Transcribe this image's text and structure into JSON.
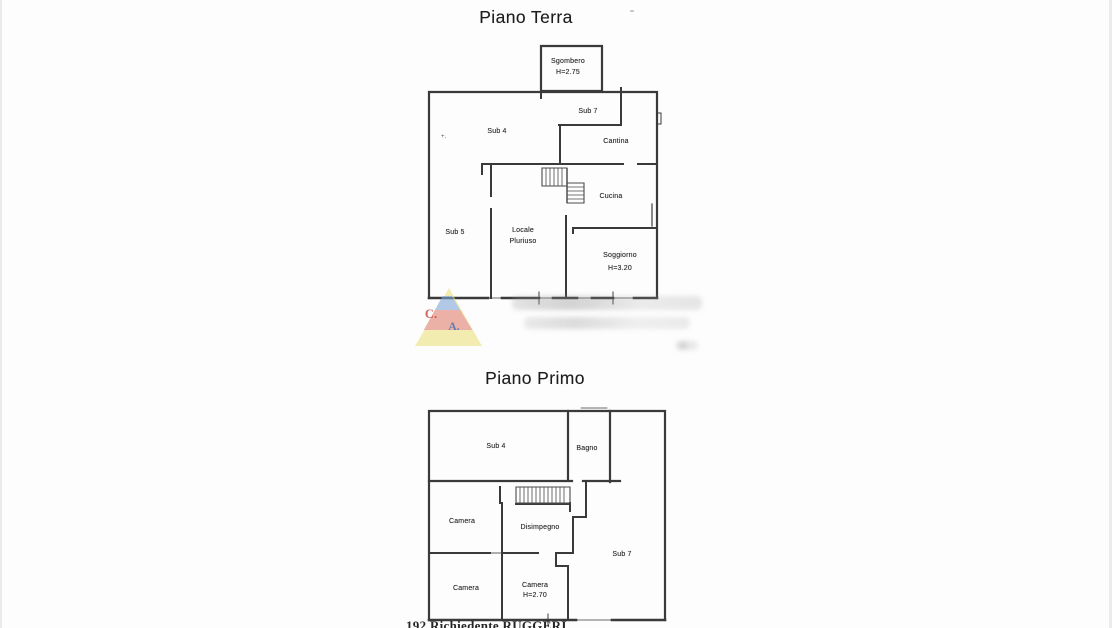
{
  "page": {
    "background": "#fdfdfd",
    "line_color": "#3a3a3a",
    "footer_text": "192   Richiedente RUGGERI",
    "artifact_text": "+."
  },
  "floors": [
    {
      "title": "Piano Terra",
      "rooms": [
        {
          "name": "Sgombero",
          "detail": "H=2.75"
        },
        {
          "name": "Sub 7",
          "detail": ""
        },
        {
          "name": "Sub 4",
          "detail": ""
        },
        {
          "name": "Cantina",
          "detail": ""
        },
        {
          "name": "Cucina",
          "detail": ""
        },
        {
          "name": "Sub 5",
          "detail": ""
        },
        {
          "name": "Locale",
          "detail": "Pluriuso"
        },
        {
          "name": "Soggiorno",
          "detail": "H=3.20"
        }
      ]
    },
    {
      "title": "Piano Primo",
      "rooms": [
        {
          "name": "Sub 4",
          "detail": ""
        },
        {
          "name": "Bagno",
          "detail": ""
        },
        {
          "name": "Camera",
          "detail": ""
        },
        {
          "name": "Disimpegno",
          "detail": ""
        },
        {
          "name": "Sub 7",
          "detail": ""
        },
        {
          "name": "Camera",
          "detail": ""
        },
        {
          "name": "Camera",
          "detail": "H=2.70"
        }
      ]
    }
  ],
  "watermark": {
    "letters": {
      "c": "C.",
      "a": "A."
    },
    "colors": {
      "yellow": "#ece27e",
      "red": "#e0806e",
      "blue": "#7fa7d8",
      "letter_c": "#c23a2c",
      "letter_a": "#3e6fb0"
    }
  }
}
